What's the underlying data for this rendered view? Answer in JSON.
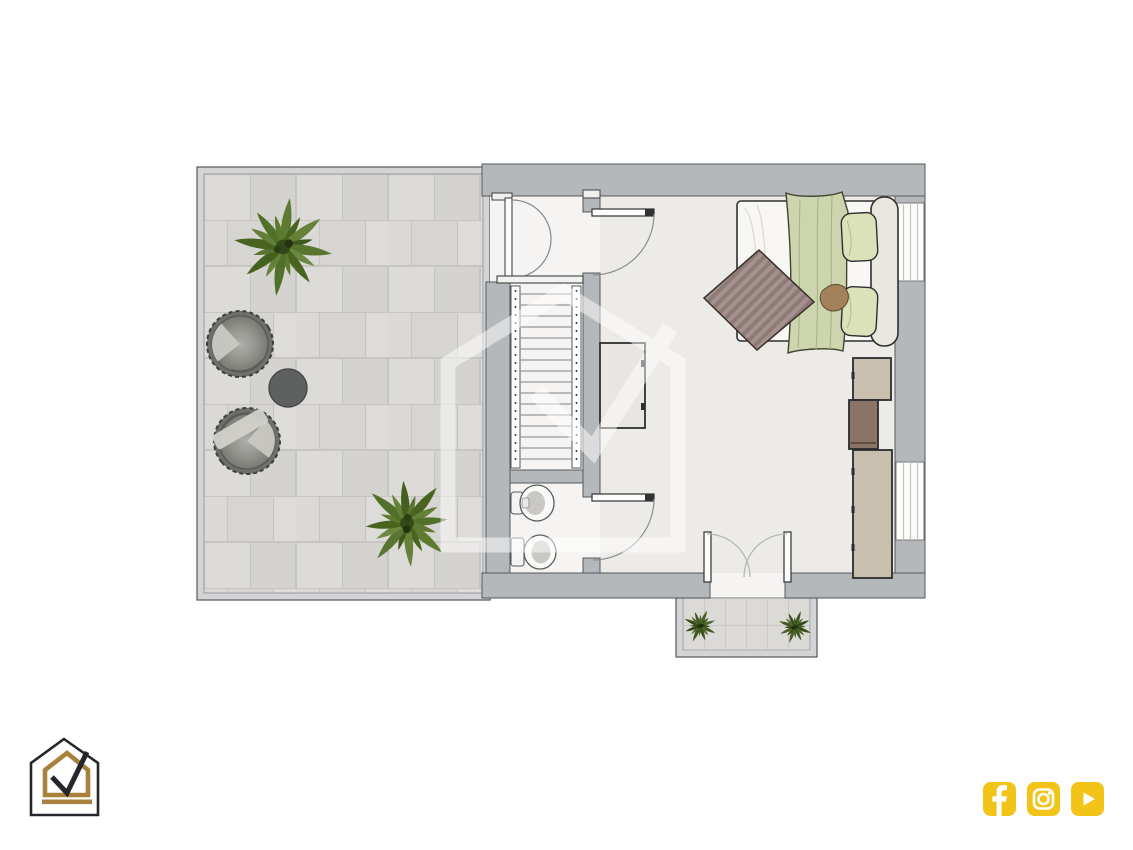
{
  "canvas": {
    "width": 1133,
    "height": 850,
    "background": "#FFFFFF"
  },
  "colors": {
    "background": "#FFFFFF",
    "wall": "#B5B8BB",
    "wallLine": "#55585B",
    "railing": "#D2D4D5",
    "terraceTile": "#D8D7D4",
    "balconyTile": "#DBDAD7",
    "bedroomFloor": "#EDEBE7",
    "whiteFloor": "#F5F4F2",
    "stairLine": "#97979A",
    "woodBeige": "#C9BFAE",
    "woodBrown": "#8B7365",
    "bedWhite": "#F8F7F4",
    "headboard": "#EAE7E0",
    "blanketGreen": "#CCD5AD",
    "pillowGreen": "#DBE1B8",
    "throwMauve": "#9C8C8A",
    "plantGreen": "#5D7A30",
    "chairGray": "#8C8D8A",
    "tableDark": "#5E605F",
    "fixtureWhite": "#F9F9F7",
    "social": "#F2C417",
    "gold": "#A8823D",
    "logoDark": "#24262B",
    "watermark": "#FFFFFF"
  },
  "branding": {
    "logo": {
      "icon": "house-checkmark-logo"
    },
    "social_icons": [
      {
        "icon": "facebook-icon"
      },
      {
        "icon": "instagram-icon"
      },
      {
        "icon": "youtube-icon"
      }
    ]
  },
  "floorplan": {
    "watermark_icon": "house-checkmark-watermark",
    "rooms": [
      {
        "name": "terrace",
        "items": [
          "potted-plant",
          "potted-plant",
          "round-lounge-chair",
          "round-lounge-chair",
          "round-side-table"
        ]
      },
      {
        "name": "stair-hall",
        "items": [
          "double-swing-door",
          "staircase"
        ]
      },
      {
        "name": "bathroom",
        "items": [
          "bidet",
          "toilet",
          "swing-door"
        ]
      },
      {
        "name": "bedroom",
        "items": [
          "double-bed",
          "green-blanket",
          "pillows",
          "patterned-throw",
          "desk",
          "swing-door",
          "wardrobe-cabinet",
          "wardrobe-drawer",
          "wardrobe-tall",
          "window",
          "window"
        ]
      },
      {
        "name": "balcony",
        "items": [
          "potted-plant",
          "potted-plant",
          "french-double-door"
        ]
      }
    ]
  }
}
